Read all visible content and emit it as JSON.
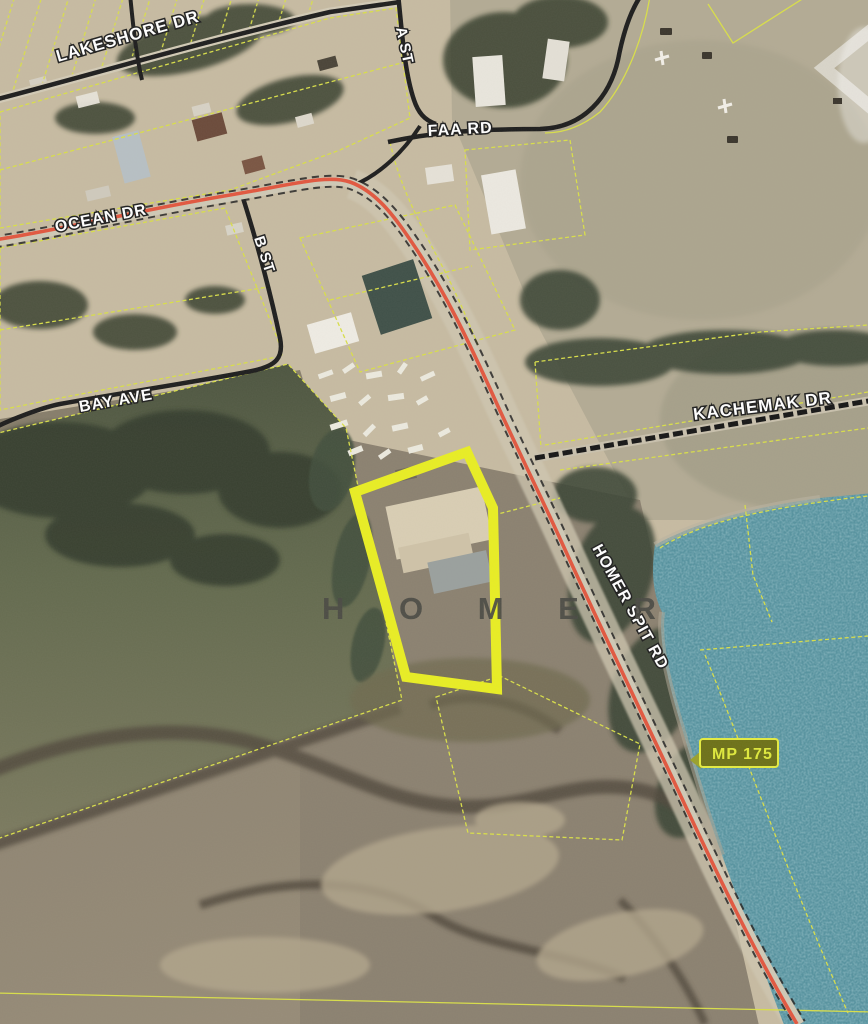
{
  "map": {
    "place_label": "H O M E R",
    "road_labels": [
      {
        "id": "lakeshore-dr",
        "text": "LAKESHORE DR"
      },
      {
        "id": "a-st",
        "text": "A ST"
      },
      {
        "id": "faa-rd",
        "text": "FAA RD"
      },
      {
        "id": "ocean-dr",
        "text": "OCEAN DR"
      },
      {
        "id": "b-st",
        "text": "B ST"
      },
      {
        "id": "bay-ave",
        "text": "BAY AVE"
      },
      {
        "id": "kachemak-dr",
        "text": "KACHEMAK DR"
      },
      {
        "id": "homer-spit-rd",
        "text": "HOMER SPIT RD"
      }
    ],
    "milepost": {
      "text": "MP 175"
    },
    "colors": {
      "parcel_line": "#d9df49",
      "highlight_parcel": "#e9ee23",
      "highway_red": "#e2573f",
      "road_black": "#1d1d1d",
      "water": "#55929f",
      "label_fill": "#ffffff",
      "label_outline": "#1f1f1f",
      "milepost_bg": "#6d7118",
      "milepost_text": "#dfe93c",
      "place_text": "#4a4a44",
      "terrain_tan": "#c7bba2",
      "marsh_brown": "#8a7f6f",
      "forest_green": "#39412f"
    }
  }
}
